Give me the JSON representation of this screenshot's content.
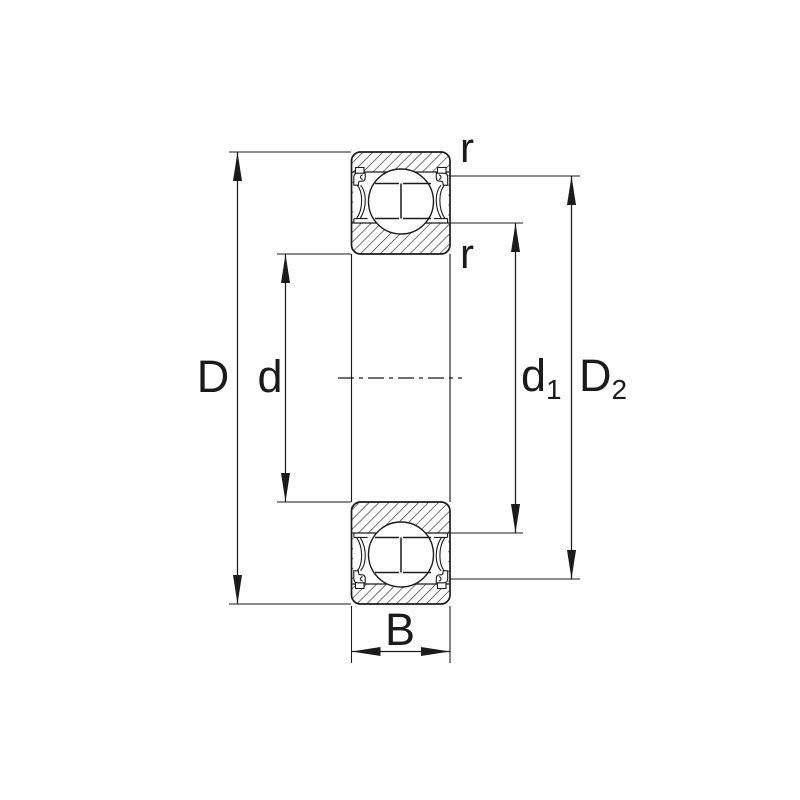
{
  "figure": {
    "kind": "bearing-cross-section-drawing",
    "background": "#ffffff"
  },
  "colors": {
    "line": "#1b1b1b",
    "background": "#ffffff"
  },
  "dims": {
    "D": {
      "label": "D"
    },
    "d": {
      "label": "d"
    },
    "d1": {
      "base": "d",
      "sub": "1"
    },
    "D2": {
      "base": "D",
      "sub": "2"
    },
    "B": {
      "label": "B"
    },
    "r_outer": {
      "label": "r"
    },
    "r_inner": {
      "label": "r"
    }
  }
}
